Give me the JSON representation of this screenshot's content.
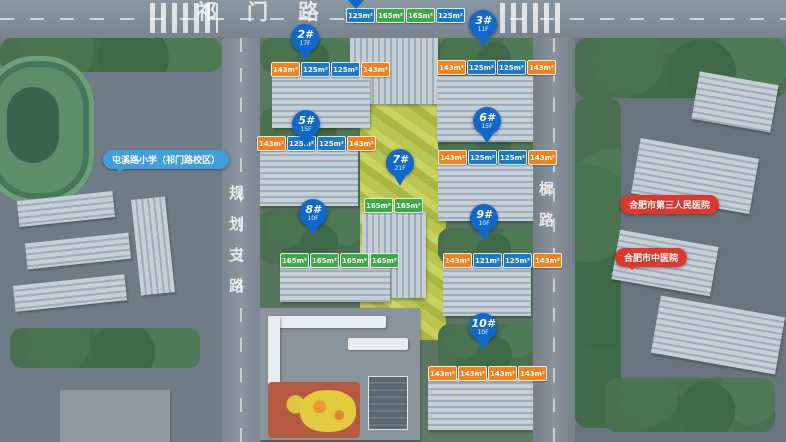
{
  "roads": {
    "top": "祁门路",
    "left": "规划支路",
    "right": "棠樨路"
  },
  "pois": {
    "school": {
      "label": "屯溪路小学（祁门路校区）"
    },
    "hospital_top": {
      "label": "合肥市第三人民医院"
    },
    "hospital_bottom": {
      "label": "合肥市中医院"
    }
  },
  "pins": [
    {
      "id": "2",
      "label": "2#",
      "floors": "17F"
    },
    {
      "id": "3",
      "label": "3#",
      "floors": "11F"
    },
    {
      "id": "5",
      "label": "5#",
      "floors": "15F"
    },
    {
      "id": "6",
      "label": "6#",
      "floors": "15F"
    },
    {
      "id": "7",
      "label": "7#",
      "floors": "21F"
    },
    {
      "id": "8",
      "label": "8#",
      "floors": "10F"
    },
    {
      "id": "9",
      "label": "9#",
      "floors": "10F"
    },
    {
      "id": "10",
      "label": "10#",
      "floors": "10F"
    }
  ],
  "banners": [
    {
      "building": "1#",
      "tags": [
        {
          "text": "125m²",
          "type": "blue"
        },
        {
          "text": "165m²",
          "type": "green"
        },
        {
          "text": "165m²",
          "type": "green"
        },
        {
          "text": "125m²",
          "type": "blue"
        }
      ]
    },
    {
      "building": "2#",
      "tags": [
        {
          "text": "143m²",
          "type": "orange"
        },
        {
          "text": "125m²",
          "type": "blue"
        },
        {
          "text": "125m²",
          "type": "blue"
        },
        {
          "text": "143m²",
          "type": "orange"
        }
      ]
    },
    {
      "building": "3#",
      "tags": [
        {
          "text": "143m²",
          "type": "orange"
        },
        {
          "text": "125m²",
          "type": "blue"
        },
        {
          "text": "125m²",
          "type": "blue"
        },
        {
          "text": "143m²",
          "type": "orange"
        }
      ]
    },
    {
      "building": "5#",
      "tags": [
        {
          "text": "143m²",
          "type": "orange"
        },
        {
          "text": "125m²",
          "type": "blue"
        },
        {
          "text": "125m²",
          "type": "blue"
        },
        {
          "text": "143m²",
          "type": "orange"
        }
      ]
    },
    {
      "building": "6#",
      "tags": [
        {
          "text": "143m²",
          "type": "orange"
        },
        {
          "text": "125m²",
          "type": "blue"
        },
        {
          "text": "125m²",
          "type": "blue"
        },
        {
          "text": "143m²",
          "type": "orange"
        }
      ]
    },
    {
      "building": "7#",
      "tags": [
        {
          "text": "165m²",
          "type": "green"
        },
        {
          "text": "165m²",
          "type": "green"
        }
      ]
    },
    {
      "building": "8#",
      "tags": [
        {
          "text": "165m²",
          "type": "green"
        },
        {
          "text": "165m²",
          "type": "green"
        },
        {
          "text": "165m²",
          "type": "green"
        },
        {
          "text": "165m²",
          "type": "green"
        }
      ]
    },
    {
      "building": "9#",
      "tags": [
        {
          "text": "143m²",
          "type": "orange"
        },
        {
          "text": "121m²",
          "type": "blue"
        },
        {
          "text": "125m²",
          "type": "blue"
        },
        {
          "text": "143m²",
          "type": "orange"
        }
      ]
    },
    {
      "building": "10#",
      "tags": [
        {
          "text": "143m²",
          "type": "orange"
        },
        {
          "text": "143m²",
          "type": "orange"
        },
        {
          "text": "143m²",
          "type": "orange"
        },
        {
          "text": "143m²",
          "type": "orange"
        }
      ]
    }
  ],
  "colors": {
    "pin": "#1168cc",
    "tag_blue": "#1e78c8",
    "tag_orange": "#f5811d",
    "tag_green": "#3fa844",
    "poi_school": "#3f9fdc",
    "poi_hospital": "#dd382c"
  }
}
